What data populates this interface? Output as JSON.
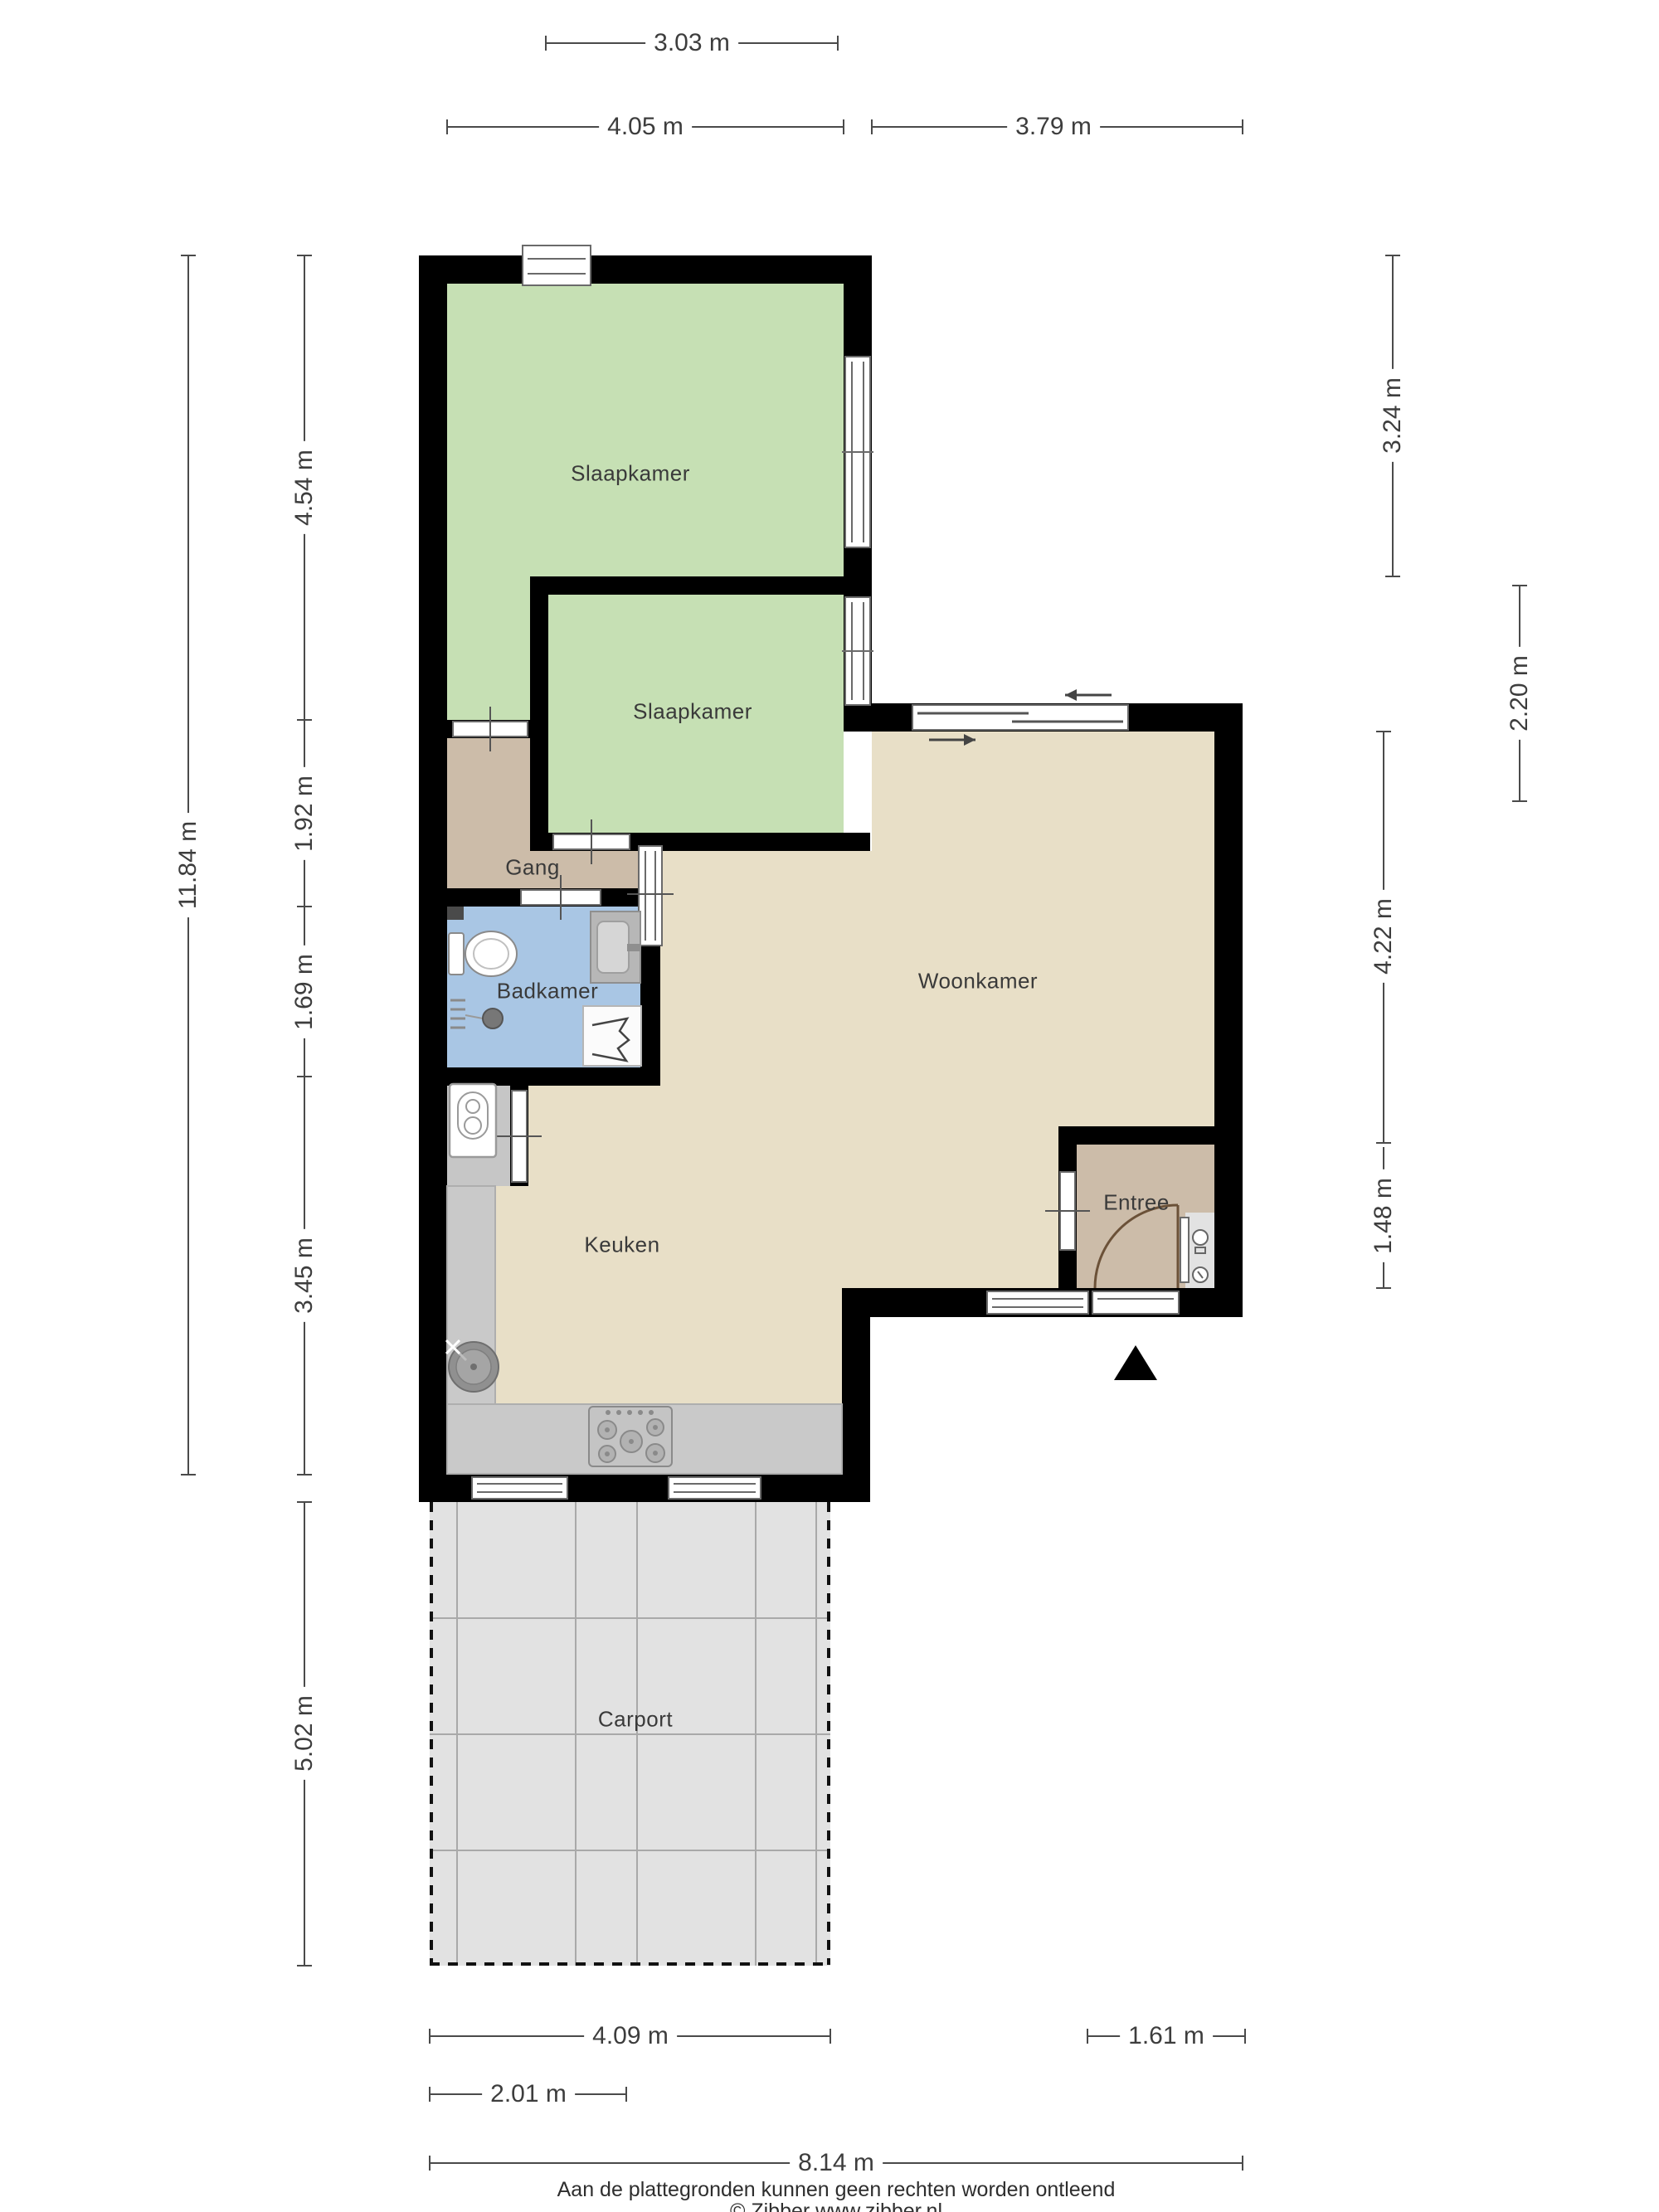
{
  "rooms": [
    {
      "name": "slaapkamer-1",
      "label": "Slaapkamer"
    },
    {
      "name": "slaapkamer-2",
      "label": "Slaapkamer"
    },
    {
      "name": "gang",
      "label": "Gang"
    },
    {
      "name": "badkamer",
      "label": "Badkamer"
    },
    {
      "name": "woonkamer",
      "label": "Woonkamer"
    },
    {
      "name": "keuken",
      "label": "Keuken"
    },
    {
      "name": "entree",
      "label": "Entree"
    },
    {
      "name": "carport",
      "label": "Carport"
    }
  ],
  "dimensions": {
    "top": [
      {
        "label": "3.03 m"
      },
      {
        "label": "4.05 m"
      },
      {
        "label": "3.79 m"
      }
    ],
    "left": [
      {
        "label": "11.84 m"
      },
      {
        "label": "4.54 m"
      },
      {
        "label": "1.92 m"
      },
      {
        "label": "1.69 m"
      },
      {
        "label": "3.45 m"
      },
      {
        "label": "5.02 m"
      }
    ],
    "right": [
      {
        "label": "3.24 m"
      },
      {
        "label": "2.20 m"
      },
      {
        "label": "4.22 m"
      },
      {
        "label": "1.48 m"
      }
    ],
    "bottom": [
      {
        "label": "4.09 m"
      },
      {
        "label": "1.61 m"
      },
      {
        "label": "2.01 m"
      },
      {
        "label": "8.14 m"
      }
    ]
  },
  "footer": {
    "disclaimer": "Aan de plattegronden kunnen geen rechten worden ontleend",
    "credit": "© Zibber www.zibber.nl"
  },
  "icons": {
    "north_arrow": "north-arrow-icon",
    "toilet": "toilet-icon",
    "washbasin": "washbasin-icon",
    "shower": "shower-icon",
    "washing_machine": "washing-machine-icon",
    "kitchen_sink": "kitchen-sink-icon",
    "stove": "stove-icon",
    "meters": "meter-cupboard-icon"
  },
  "colors": {
    "wall": "#000000",
    "bedroom": "#c6e0b4",
    "hall": "#ccbca9",
    "bathroom": "#a9c6e4",
    "living": "#e8dfc7",
    "counter": "#c9c9c9",
    "carport": "#e2e2e2",
    "dimension_line": "#4a4a4a",
    "door_arc": "#6b5138"
  }
}
